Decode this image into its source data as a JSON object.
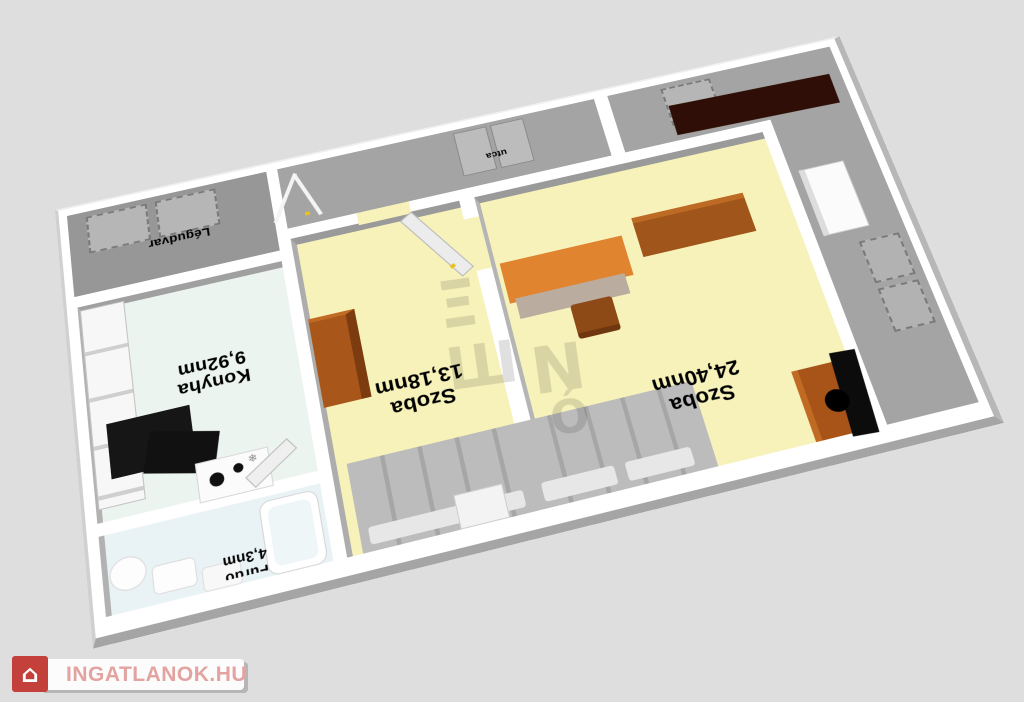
{
  "page": {
    "background": "#dedede"
  },
  "branding": {
    "logo_text": "INGATLANOK.HU",
    "logo_text_color": "#e2a3a1",
    "logo_box_color": "#c4403a",
    "house_icon": "⌂"
  },
  "watermark": {
    "glyphs": [
      "Ξ",
      "Ш",
      "N",
      "Ó"
    ]
  },
  "icons": {
    "snowflake": "❄"
  },
  "floorplan": {
    "orientation_note": "labels rendered rotated 180 degrees",
    "exterior": {
      "legudvar_label": "Légudvar",
      "street_label": "utca"
    },
    "rooms": [
      {
        "name": "Konyha",
        "area": "9,92nm"
      },
      {
        "name": "Szoba",
        "area": "13,18nm"
      },
      {
        "name": "Szoba",
        "area": "24,40nm"
      },
      {
        "name": "Fürdő",
        "area": "4,3nm"
      }
    ],
    "colors": {
      "room_floor": "#f7f2ba",
      "kitchen_floor": "#ecf4f0",
      "bath_floor": "#e9f3f6",
      "exterior_floor": "#a4a4a4",
      "wall": "#ffffff",
      "furniture_orange": "#a9561b",
      "desk_orange": "#e08430",
      "dark_maroon": "#2e0e06",
      "bed_gray": "#bcbcbc",
      "appliance_black": "#141414",
      "handle_yellow": "#e6c11f"
    }
  }
}
